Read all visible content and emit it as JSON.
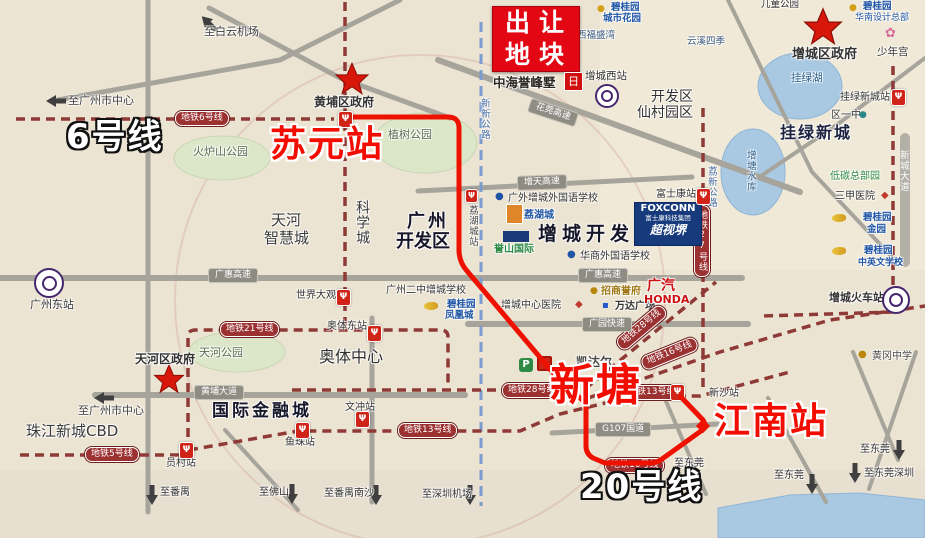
{
  "ann": {
    "line6": "6号线",
    "suyuan": "苏元站",
    "xintang": "新塘",
    "jiangnan": "江南站",
    "line20": "20号线"
  },
  "parcel": {
    "l1": "出让",
    "l2": "地块",
    "brand": "中海誉峰墅",
    "logo": "日"
  },
  "pill": {
    "m6": "地铁6号线",
    "m21": "地铁21号线",
    "m5": "地铁5号线",
    "m13w": "地铁13号线",
    "m13e": "地铁13号线",
    "m28h": "地铁28号线",
    "m28d": "地铁28号线",
    "m16": "地铁16号线",
    "m16p": "地铁16号线",
    "m27": "地铁27号线",
    "ghw": "广惠高速",
    "ghe": "广惠高速",
    "hpdd": "黄埔大道",
    "zt": "增天高速",
    "hg": "花莞高速",
    "gy": "广园快速",
    "g107": "G107国道"
  },
  "vroad": {
    "xinxin": "新新公路",
    "lixin": "荔新公路",
    "xincheng": "新城大道"
  },
  "st": {
    "yuancun": "员村站",
    "yuzhu": "鱼珠站",
    "wenchong": "文冲站",
    "aotidong": "奥体东站",
    "sjdg": "世界大观",
    "xinsha": "新沙站",
    "fsk": "富士康站",
    "glxc": "挂绿新城站",
    "gzdong": "广州东站",
    "zcxi": "增城西站",
    "zchuoche": "增城火车站",
    "lihucheng": "荔湖城站"
  },
  "area": {
    "thzhc1": "天河",
    "thzhc2": "智慧城",
    "kxc": "科学城",
    "gzkfq1": "广州",
    "gzkfq2": "开发区",
    "zckfq": "增城开发区",
    "gjjrc": "国际金融城",
    "aoti": "奥体中心",
    "zjcbd": "珠江新城CBD",
    "glxc": "挂绿新城",
    "kfq1": "开发区",
    "kfq2": "仙村园区"
  },
  "poi": {
    "hpgov": "黄埔区政府",
    "thgov": "天河区政府",
    "zcgov": "增城区政府",
    "hlspark": "火炉山公园",
    "zspark": "植树公园",
    "thpark": "天河公园",
    "gllake": "挂绿湖",
    "ztsk": "增塘水库",
    "etgy": "儿童公园",
    "snq": "少年宫",
    "qyz": "区一中",
    "bgy1a": "碧桂园",
    "bgy1b": "城市花园",
    "xfsw": "西福盛湾",
    "yxsj": "云溪四季",
    "bgy2a": "碧桂园",
    "bgy2b": "华南设计总部",
    "dtzby": "低碳总部园",
    "sjyy": "三甲医院",
    "bgy3a": "碧桂园",
    "bgy3b": "金园",
    "bgy4a": "碧桂园",
    "bgy4b": "中英文学校",
    "foxconn": "FOXCONN",
    "foxsub": "富士康科技集团",
    "csj": "超视堺",
    "gwsch": "广外增城外国语学校",
    "lhc": "荔湖城",
    "ysgj": "誉山国际",
    "hssch": "华商外国语学校",
    "gzez": "广州二中增城学校",
    "bgy5a": "碧桂园",
    "bgy5b": "凤凰城",
    "zchosp": "增城中心医院",
    "zsyf": "招商誉府",
    "wanda": "万达广场",
    "gqa": "广汽",
    "gqb": "HONDA",
    "kdr": "凯达尔",
    "hgzx": "黄冈中学"
  },
  "dir": {
    "byjc": "至白云机场",
    "gzc1": "至广州市中心",
    "gzc2": "至广州市中心",
    "py": "至番禺",
    "fs": "至佛山",
    "pyns": "至番禺南沙",
    "szjc": "至深圳机场",
    "dg1": "至东莞",
    "dg2": "至东莞",
    "dg3": "至东莞",
    "dgsz": "至东莞深圳"
  },
  "icons": {
    "metro": "Ψ",
    "flower": "✿",
    "diamond": "◆",
    "dot": "●",
    "square": "▪",
    "p": "P"
  },
  "colors": {
    "route": "#ee1100",
    "metro_line": "#8f3a36",
    "road": "#a7a49c",
    "parcel_red": "#e30613",
    "annotation_red": "#f20d00"
  }
}
